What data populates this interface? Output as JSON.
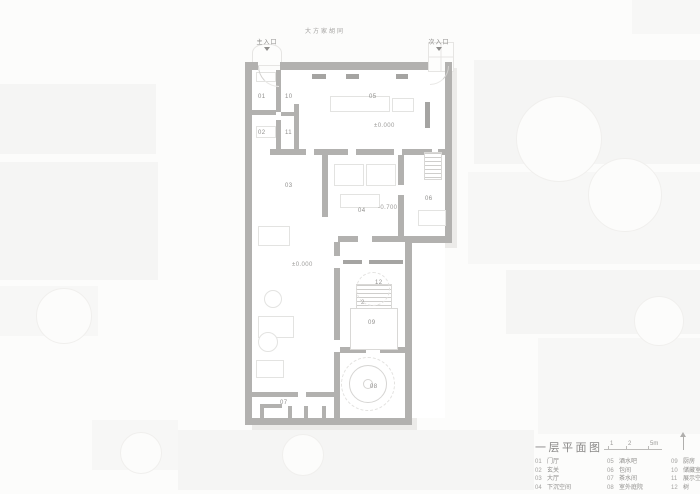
{
  "street": {
    "name": "大方家胡同"
  },
  "entrances": {
    "main": "主入口",
    "secondary": "次入口"
  },
  "plan_labels": [
    {
      "text": "01"
    },
    {
      "text": "02"
    },
    {
      "text": "10"
    },
    {
      "text": "11"
    },
    {
      "text": "05"
    },
    {
      "text": "±0.000"
    },
    {
      "text": "03"
    },
    {
      "text": "04"
    },
    {
      "text": "-0.700"
    },
    {
      "text": "06"
    },
    {
      "text": "±0.000"
    },
    {
      "text": "12"
    },
    {
      "text": "2"
    },
    {
      "text": "09"
    },
    {
      "text": "08"
    },
    {
      "text": "07"
    }
  ],
  "title_block": {
    "title": "一层平面图",
    "scale_labels": [
      "1",
      "2",
      "5m"
    ]
  },
  "legend": {
    "columns": [
      {
        "items": [
          {
            "num": "01",
            "name": "门厅"
          },
          {
            "num": "02",
            "name": "玄关"
          },
          {
            "num": "03",
            "name": "大厅"
          },
          {
            "num": "04",
            "name": "下沉空间"
          }
        ]
      },
      {
        "items": [
          {
            "num": "05",
            "name": "酒水吧"
          },
          {
            "num": "06",
            "name": "包间"
          },
          {
            "num": "07",
            "name": "茶水间"
          },
          {
            "num": "08",
            "name": "室外庭院"
          }
        ]
      },
      {
        "items": [
          {
            "num": "09",
            "name": "厨房"
          },
          {
            "num": "10",
            "name": "储藏室"
          },
          {
            "num": "11",
            "name": "展示空间"
          },
          {
            "num": "12",
            "name": "树"
          }
        ]
      }
    ]
  },
  "colors": {
    "wall": "#b2b1af",
    "context": "#f5f5f4",
    "text": "#8f8e8c",
    "shadow": "#ecebe9"
  }
}
